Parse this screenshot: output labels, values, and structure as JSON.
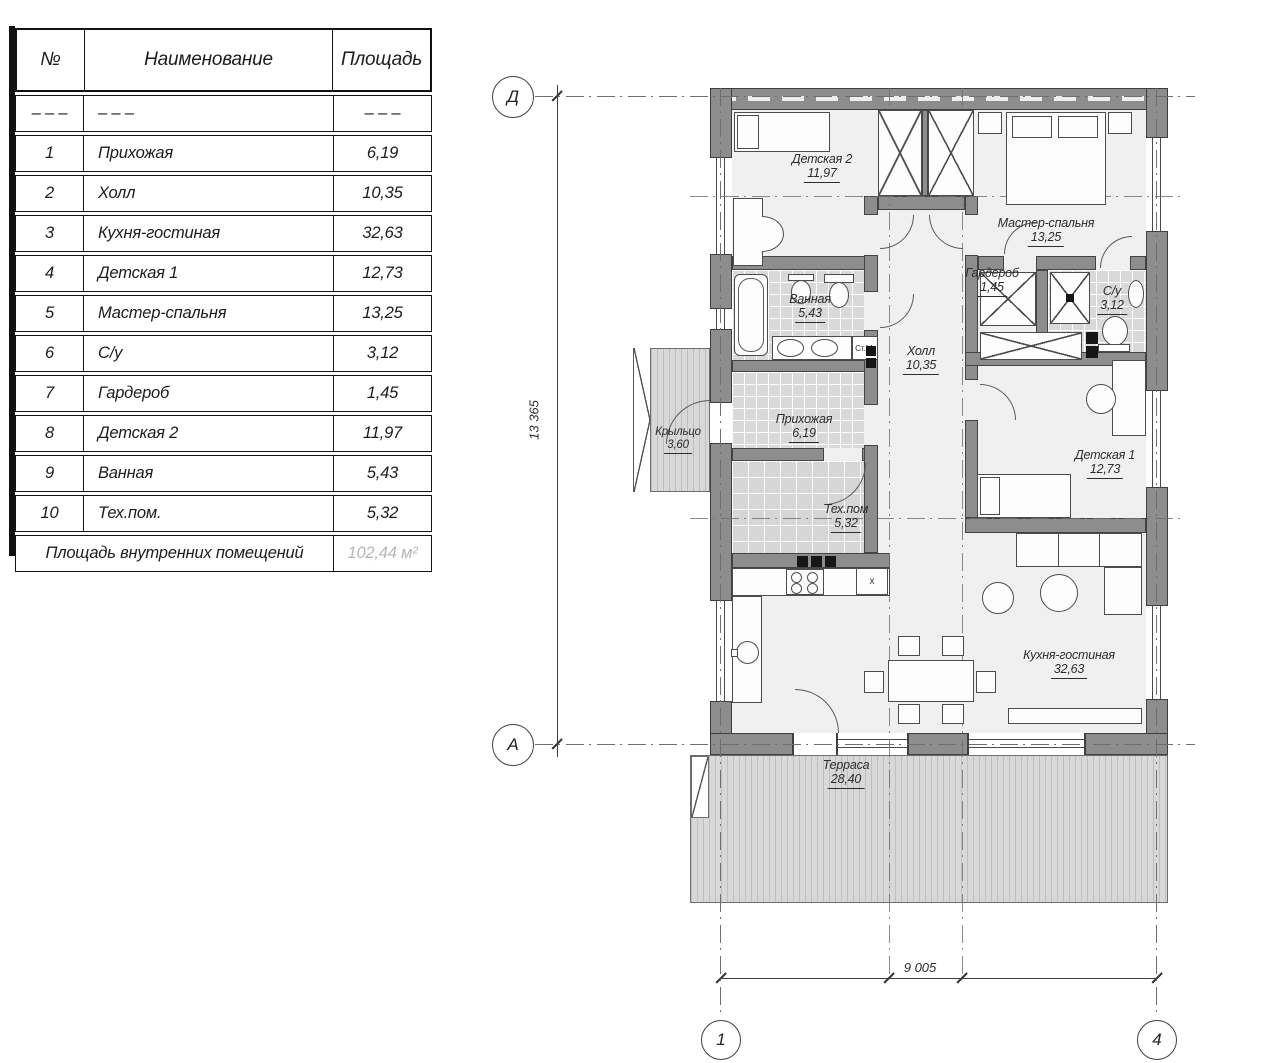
{
  "table": {
    "headers": {
      "num": "№",
      "name": "Наименование",
      "area": "Площадь"
    },
    "rows": [
      {
        "num": "– – –",
        "name": "– – –",
        "area": "– – –"
      },
      {
        "num": "1",
        "name": "Прихожая",
        "area": "6,19"
      },
      {
        "num": "2",
        "name": "Холл",
        "area": "10,35"
      },
      {
        "num": "3",
        "name": "Кухня-гостиная",
        "area": "32,63"
      },
      {
        "num": "4",
        "name": "Детская 1",
        "area": "12,73"
      },
      {
        "num": "5",
        "name": "Мастер-спальня",
        "area": "13,25"
      },
      {
        "num": "6",
        "name": "С/у",
        "area": "3,12"
      },
      {
        "num": "7",
        "name": "Гардероб",
        "area": "1,45"
      },
      {
        "num": "8",
        "name": "Детская 2",
        "area": "11,97"
      },
      {
        "num": "9",
        "name": "Ванная",
        "area": "5,43"
      },
      {
        "num": "10",
        "name": "Тех.пом.",
        "area": "5,32"
      }
    ],
    "footer": {
      "label": "Площадь внутренних помещений",
      "value": "102,44 м²"
    }
  },
  "plan": {
    "axes": {
      "row_top": "Д",
      "row_bottom": "А",
      "col_left": "1",
      "col_right": "4"
    },
    "dims": {
      "vertical": "13 365",
      "horizontal": "9 005"
    },
    "rooms": {
      "detskaya2": {
        "name": "Детская 2",
        "area": "11,97"
      },
      "master": {
        "name": "Мастер-спальня",
        "area": "13,25"
      },
      "vannaya": {
        "name": "Ванная",
        "area": "5,43"
      },
      "garderob": {
        "name": "Гардероб",
        "area": "1,45"
      },
      "su": {
        "name": "С/у",
        "area": "3,12"
      },
      "holl": {
        "name": "Холл",
        "area": "10,35"
      },
      "prihozhaya": {
        "name": "Прихожая",
        "area": "6,19"
      },
      "krylco": {
        "name": "Крыльцо",
        "area": "3,60"
      },
      "tehpom": {
        "name": "Тех.пом",
        "area": "5,32"
      },
      "detskaya1": {
        "name": "Детская 1",
        "area": "12,73"
      },
      "kuhnya": {
        "name": "Кухня-гостиная",
        "area": "32,63"
      },
      "terrasa": {
        "name": "Терраса",
        "area": "28,40"
      }
    },
    "markers": {
      "washing_machine": "Ст.М.",
      "sink": "x"
    }
  },
  "colors": {
    "wall": "#8d8d8d",
    "line": "#3f3f3f",
    "tile": "#d9d9d9",
    "muted_total": "#b3b8b6"
  }
}
